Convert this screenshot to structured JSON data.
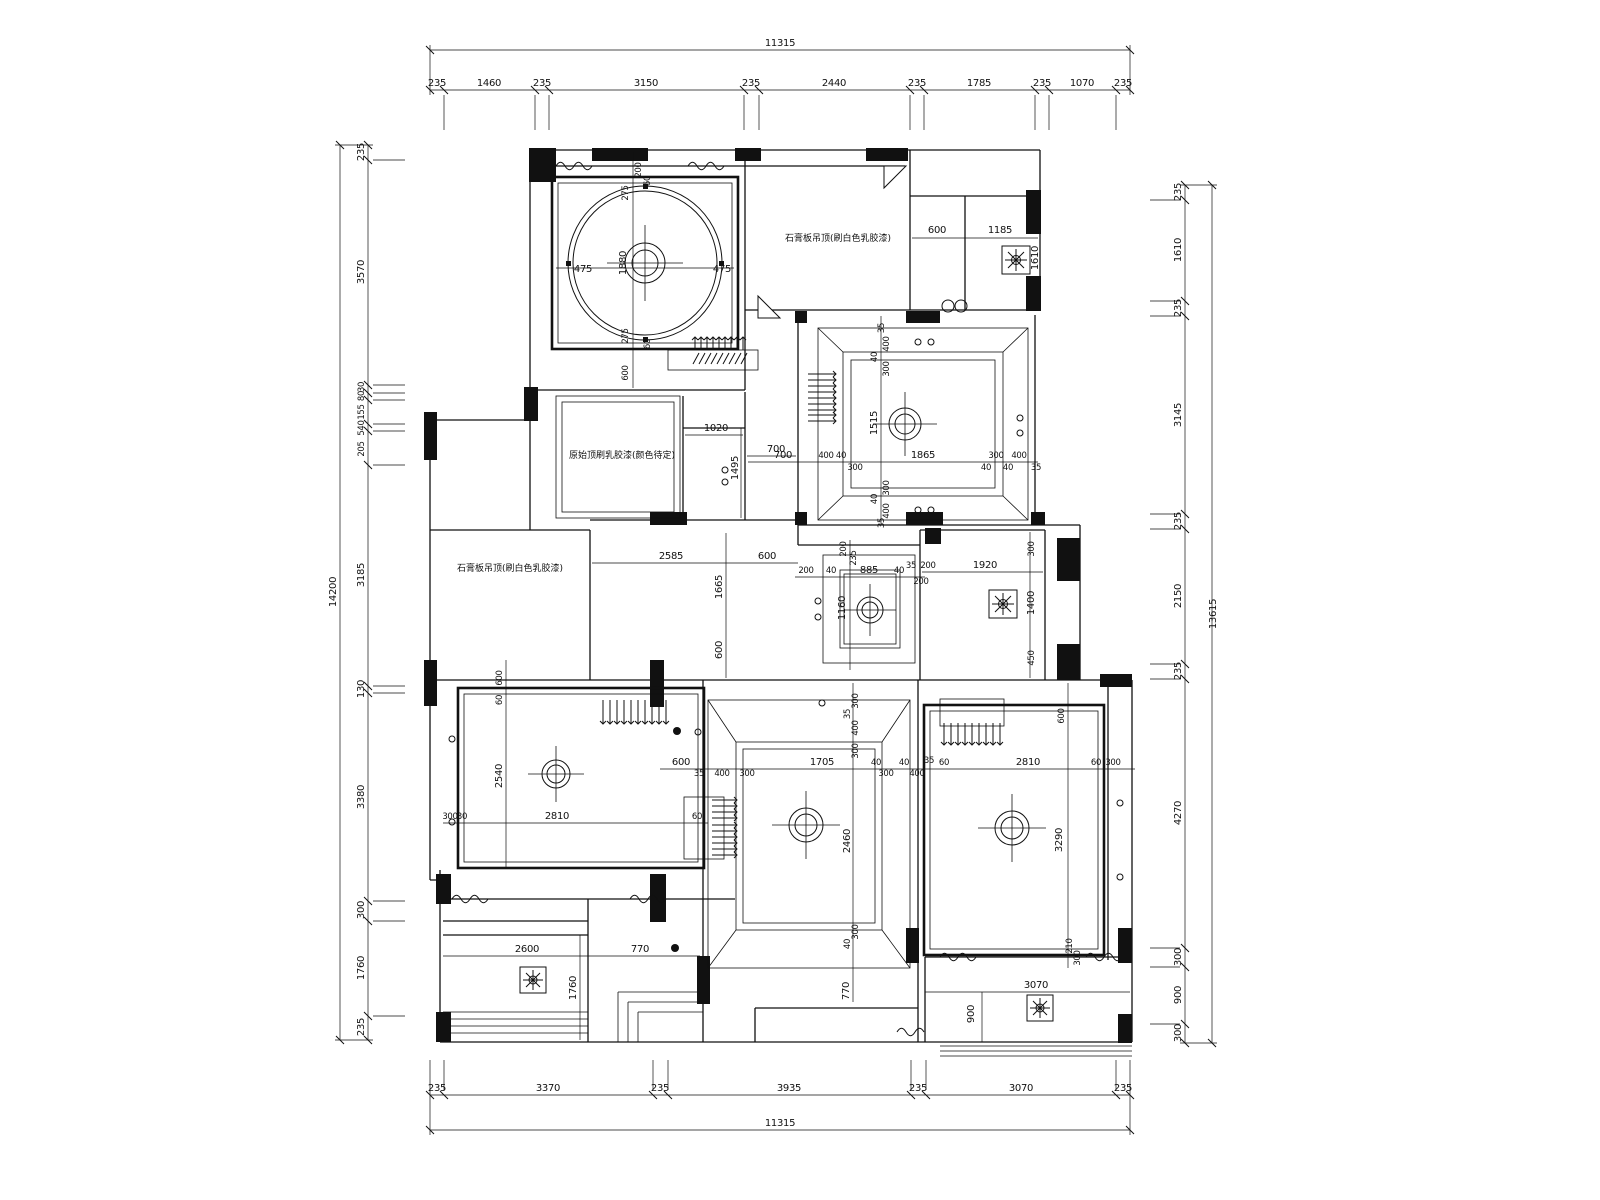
{
  "chains": {
    "top": {
      "total": "11315",
      "segments": [
        "235",
        "1460",
        "235",
        "3150",
        "235",
        "2440",
        "235",
        "1785",
        "235",
        "1070",
        "235"
      ]
    },
    "bottom": {
      "total": "11315",
      "segments": [
        "235",
        "3370",
        "235",
        "3935",
        "235",
        "3070",
        "235"
      ]
    },
    "left": {
      "total": "14200",
      "segments": [
        "235",
        "3570",
        "30",
        "80",
        "155",
        "540",
        "205",
        "3185",
        "130",
        "3380",
        "300",
        "1760",
        "235"
      ]
    },
    "right": {
      "total": "13615",
      "segments": [
        "235",
        "1610",
        "235",
        "3145",
        "235",
        "2150",
        "235",
        "4270",
        "300",
        "900",
        "300"
      ]
    }
  },
  "rooms": {
    "circle": {
      "d1": "475",
      "d2": "475",
      "d3": "200",
      "d4": "275",
      "d5": "1880",
      "d6": "275",
      "d7": "600",
      "d8": "60",
      "d9": "60"
    },
    "topright": {
      "d1": "600",
      "d2": "1185",
      "d3": "1610"
    },
    "coffered": {
      "h1": "700",
      "h2": "400",
      "h3": "40",
      "h4": "300",
      "h5": "1865",
      "h6": "300",
      "h7": "40",
      "h8": "400",
      "h9": "35",
      "h10": "40",
      "v1": "35",
      "v2": "400",
      "v3": "40",
      "v4": "300",
      "v5": "1515",
      "v6": "300",
      "v7": "40",
      "v8": "400",
      "v9": "35"
    },
    "hall": {
      "d1": "1020",
      "d2": "700",
      "d3": "1495",
      "d4": "2585",
      "d5": "1665",
      "d6": "600",
      "d7": "600"
    },
    "ctray": {
      "d1": "885",
      "d2": "1160",
      "d3": "200",
      "d4": "200",
      "d5": "200",
      "d6": "40",
      "d7": "40",
      "d8": "35",
      "d9": "235"
    },
    "bath": {
      "d1": "1920",
      "d2": "200",
      "d3": "300",
      "d4": "1400",
      "d5": "450"
    },
    "blroom": {
      "d1": "600",
      "d2": "2540",
      "d3": "300",
      "d4": "30",
      "d5": "2810",
      "d6": "60",
      "d7": "60"
    },
    "living": {
      "h1": "600",
      "h2": "35",
      "h3": "400",
      "h4": "300",
      "h5": "1705",
      "h6": "40",
      "h7": "300",
      "h8": "40",
      "h9": "400",
      "v1": "300",
      "v2": "35",
      "v3": "400",
      "v4": "300",
      "v5": "2460",
      "v6": "300",
      "v7": "40",
      "v8": "770"
    },
    "bedroom": {
      "d1": "600",
      "d2": "35",
      "d3": "60",
      "d4": "2810",
      "d5": "60",
      "d6": "300",
      "d7": "3290",
      "d8": "210",
      "d9": "300"
    },
    "balcl": {
      "d1": "2600",
      "d2": "770",
      "d3": "1760"
    },
    "balcr": {
      "d1": "3070",
      "d2": "900"
    }
  },
  "notes": {
    "n1": "石膏板吊顶(刷白色乳胶漆)",
    "n2": "原始顶刷乳胶漆(颜色待定)",
    "n3": "石膏板吊顶(刷白色乳胶漆)"
  }
}
